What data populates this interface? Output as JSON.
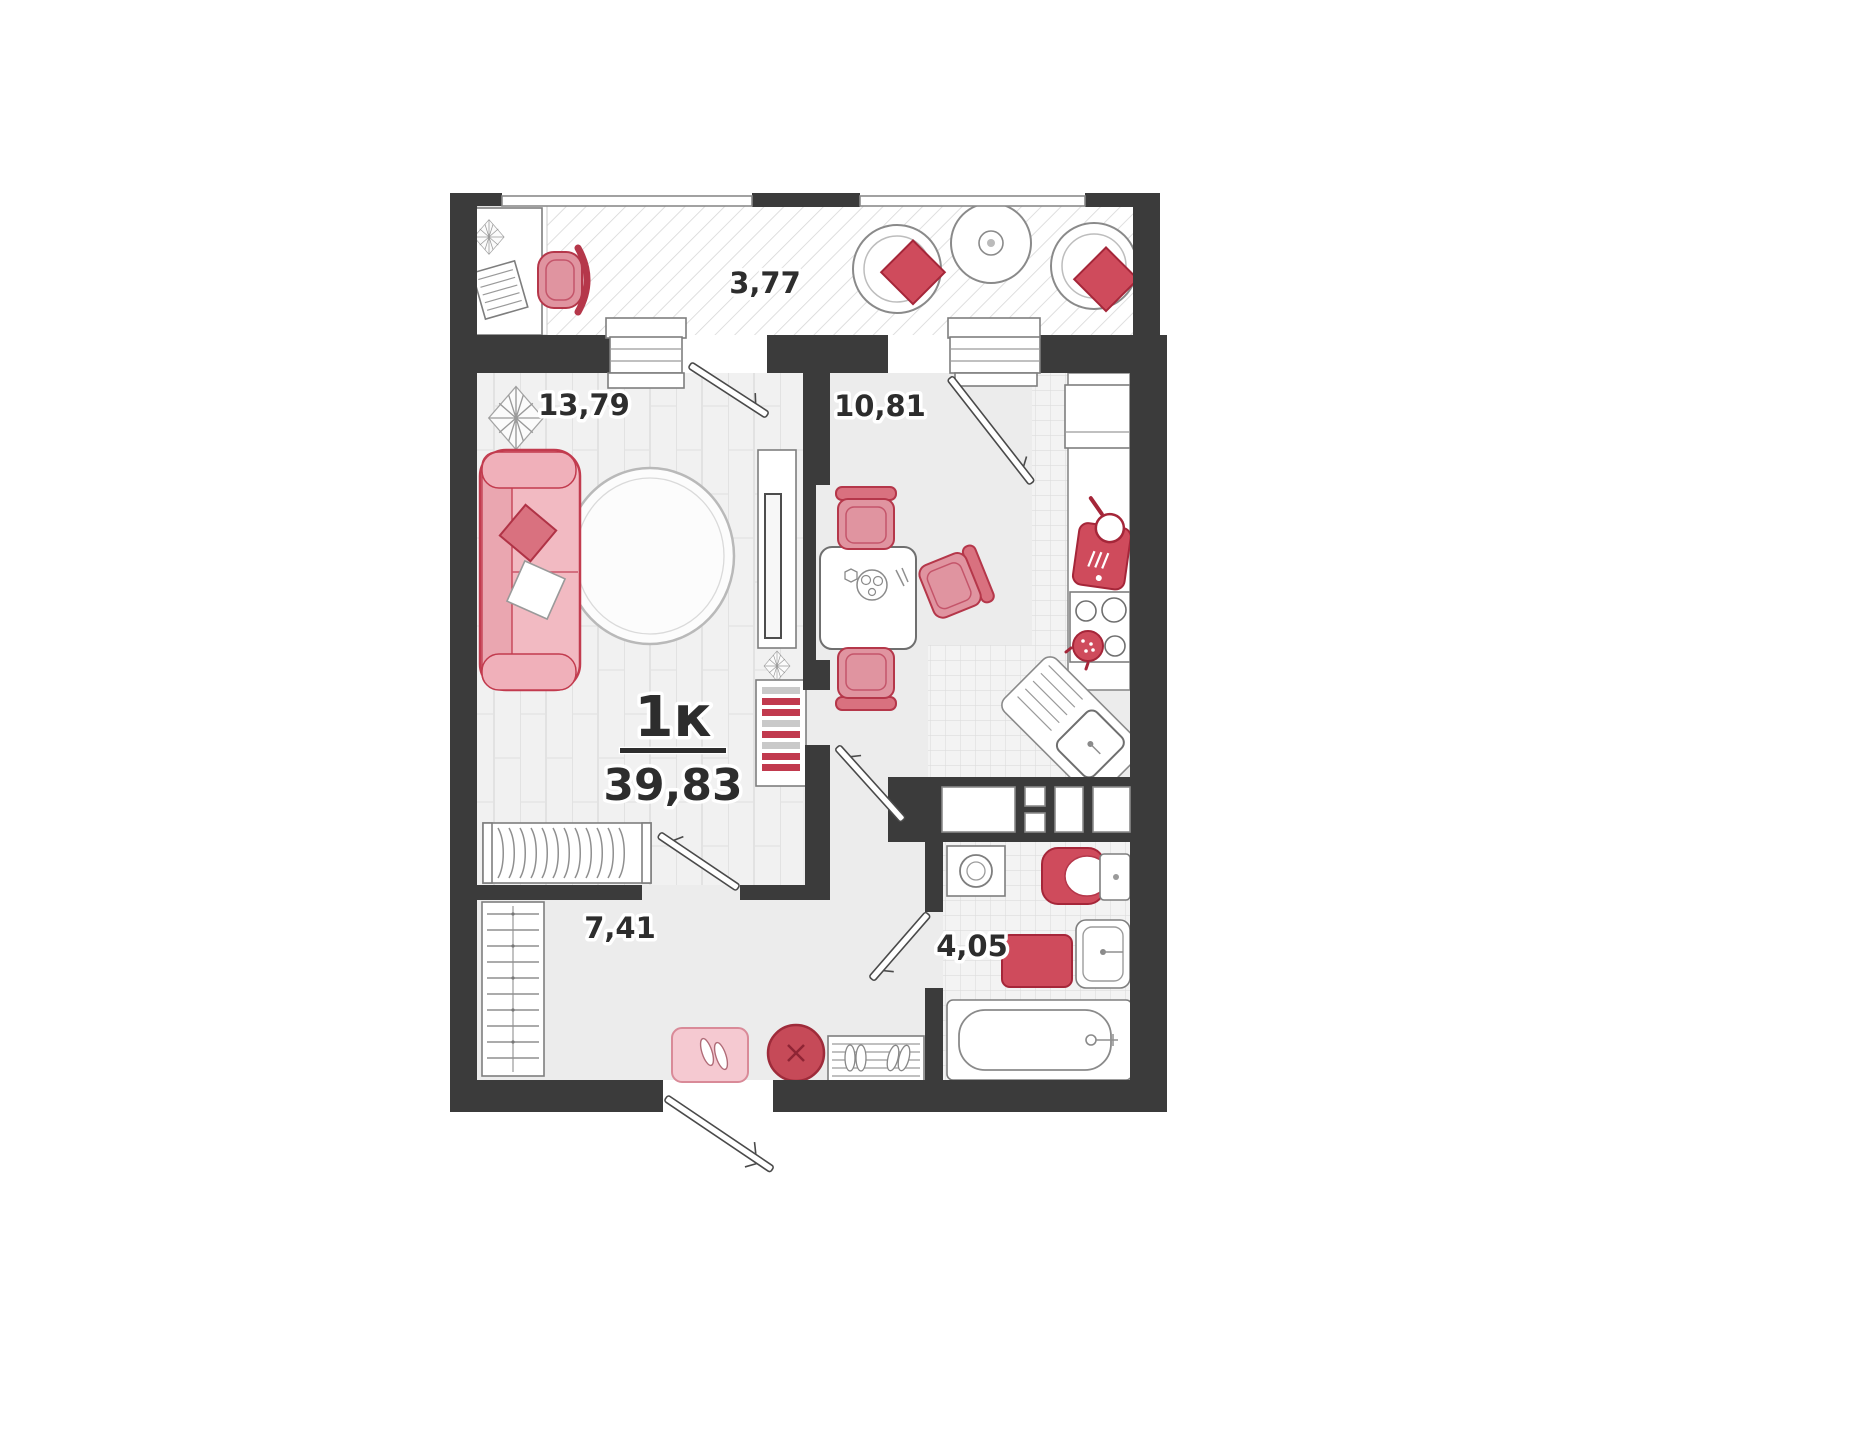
{
  "apartment": {
    "type_label": "1к",
    "total_area": "39,83"
  },
  "rooms": {
    "balcony": {
      "name": "balcony",
      "area": "3,77"
    },
    "living": {
      "name": "living-room",
      "area": "13,79"
    },
    "kitchen": {
      "name": "kitchen",
      "area": "10,81"
    },
    "hallway": {
      "name": "hallway",
      "area": "7,41"
    },
    "bathroom": {
      "name": "bathroom",
      "area": "4,05"
    }
  },
  "colors": {
    "wall": "#3b3b3b",
    "outline": "#8a8a8a",
    "ink": "#2d2d2d",
    "floor": "#ececec",
    "red": "#cf4b5c",
    "redDark": "#a52639",
    "chair": "#e094a0",
    "pinkSofa": "#f2bac2",
    "pinkMat": "#f5c9d1"
  }
}
